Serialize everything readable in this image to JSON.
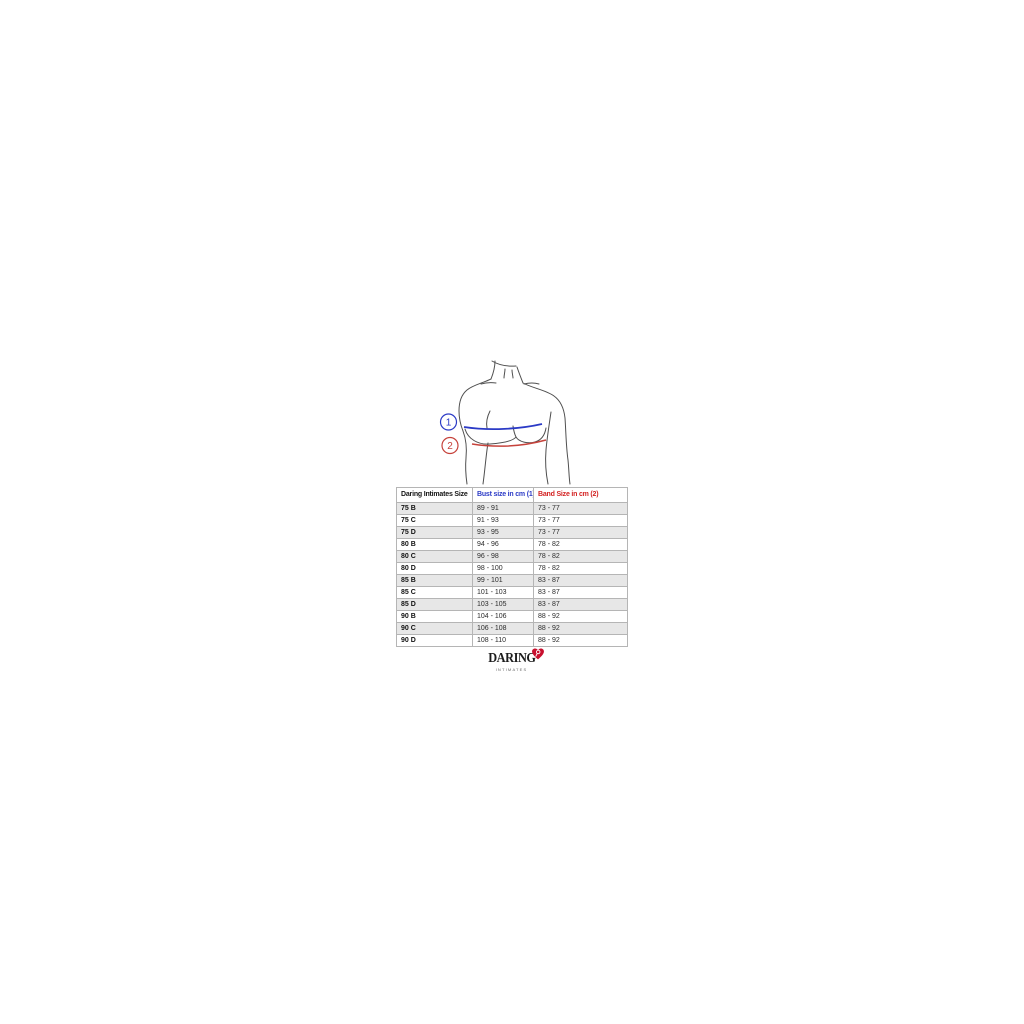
{
  "background_color": "#ffffff",
  "figure": {
    "outline_color": "#4f4f4f",
    "callouts": [
      {
        "label": "1",
        "color": "#2b3ac6"
      },
      {
        "label": "2",
        "color": "#c6423b"
      }
    ],
    "bust_line_color": "#2b3ac6",
    "band_line_color": "#c6423b"
  },
  "table": {
    "header": {
      "size_label": "Daring Intimates Size",
      "bust_label": "Bust size in cm (1)",
      "band_label": "Band Size in cm (2)",
      "bust_color": "#2b3ac6",
      "band_color": "#d32222"
    },
    "row_shade_color": "#e7e7e7",
    "border_color": "#b5b5b5",
    "rows": [
      {
        "size": "75 B",
        "bust": "89 - 91",
        "band": "73 - 77"
      },
      {
        "size": "75 C",
        "bust": "91 - 93",
        "band": "73 - 77"
      },
      {
        "size": "75 D",
        "bust": "93 - 95",
        "band": "73 - 77"
      },
      {
        "size": "80 B",
        "bust": "94 - 96",
        "band": "78 - 82"
      },
      {
        "size": "80 C",
        "bust": "96 - 98",
        "band": "78 - 82"
      },
      {
        "size": "80 D",
        "bust": "98 - 100",
        "band": "78 - 82"
      },
      {
        "size": "85 B",
        "bust": "99 - 101",
        "band": "83 - 87"
      },
      {
        "size": "85 C",
        "bust": "101 - 103",
        "band": "83 - 87"
      },
      {
        "size": "85 D",
        "bust": "103 - 105",
        "band": "83 - 87"
      },
      {
        "size": "90 B",
        "bust": "104 - 106",
        "band": "88 - 92"
      },
      {
        "size": "90 C",
        "bust": "106 - 108",
        "band": "88 - 92"
      },
      {
        "size": "90 D",
        "bust": "108 - 110",
        "band": "88 - 92"
      }
    ]
  },
  "logo": {
    "wordmark": "DARING",
    "tagline": "INTIMATES",
    "heart_color": "#c8102e"
  }
}
